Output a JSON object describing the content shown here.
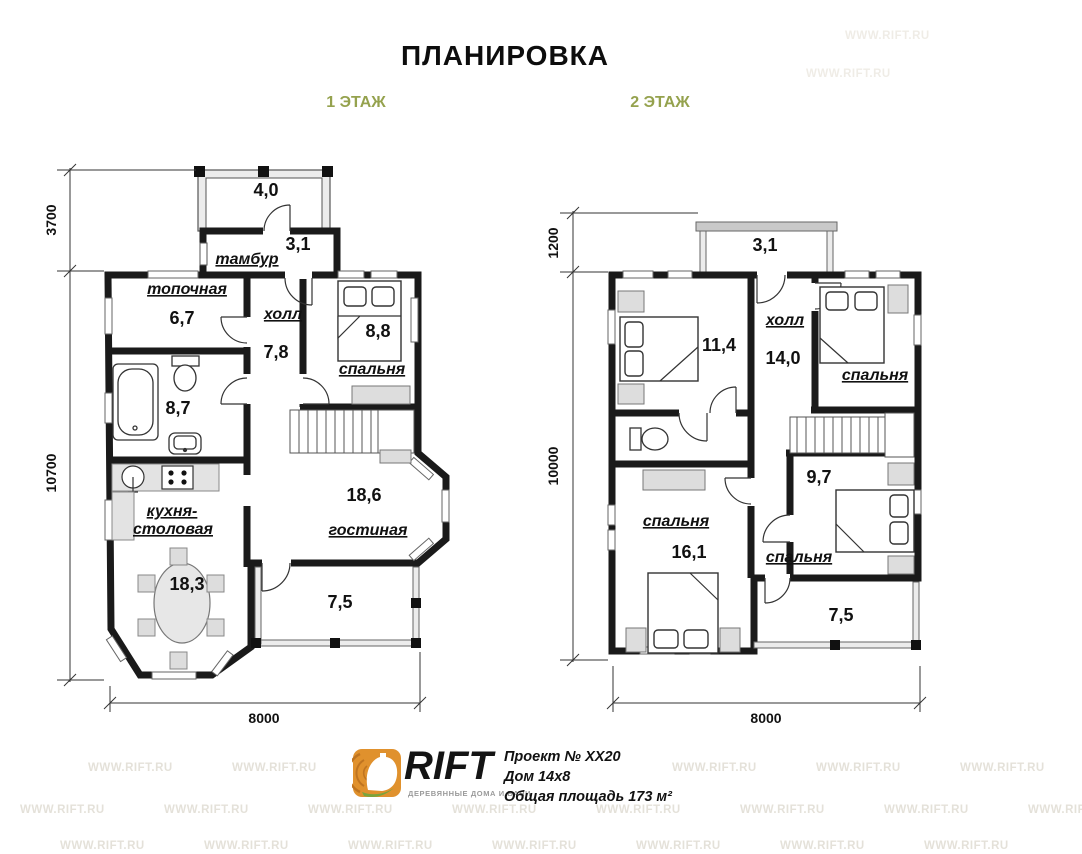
{
  "title": "ПЛАНИРОВКА",
  "floor1": {
    "label": "1 ЭТАЖ",
    "rooms": {
      "porch_area": "4,0",
      "tambour_area": "3,1",
      "tambour": "тамбур",
      "boiler": "топочная",
      "boiler_area": "6,7",
      "hall": "холл",
      "hall_area": "7,8",
      "bedroom": "спальня",
      "bedroom_area": "8,8",
      "bath_area": "8,7",
      "kitchen_line1": "кухня-",
      "kitchen_line2": "столовая",
      "kitchen_area": "18,3",
      "living": "гостиная",
      "living_area": "18,6",
      "terrace_area": "7,5"
    },
    "dims": {
      "top": "3700",
      "left": "10700",
      "bottom": "8000"
    }
  },
  "floor2": {
    "label": "2 ЭТАЖ",
    "rooms": {
      "balcony_area": "3,1",
      "bedroom1_area": "11,4",
      "hall": "холл",
      "hall_area": "14,0",
      "bedroom2": "спальня",
      "bedroom3": "спальня",
      "bedroom3_area": "16,1",
      "bedroom4": "спальня",
      "bedroom4_area": "9,7",
      "terrace_area": "7,5"
    },
    "dims": {
      "balcony": "1200",
      "left": "10000",
      "bottom": "8000"
    }
  },
  "footer": {
    "brand": "RIFT",
    "tagline": "ДЕРЕВЯННЫЕ ДОМА И БАНИ",
    "project": "Проект № ХХ20",
    "house": "Дом 14х8",
    "area_total": "Общая площадь 173 м²"
  },
  "watermark": "WWW.RIFT.RU",
  "colors": {
    "wall": "#1a1a1a",
    "accent_green": "#95a24e",
    "furniture_fill": "#dddddd"
  }
}
